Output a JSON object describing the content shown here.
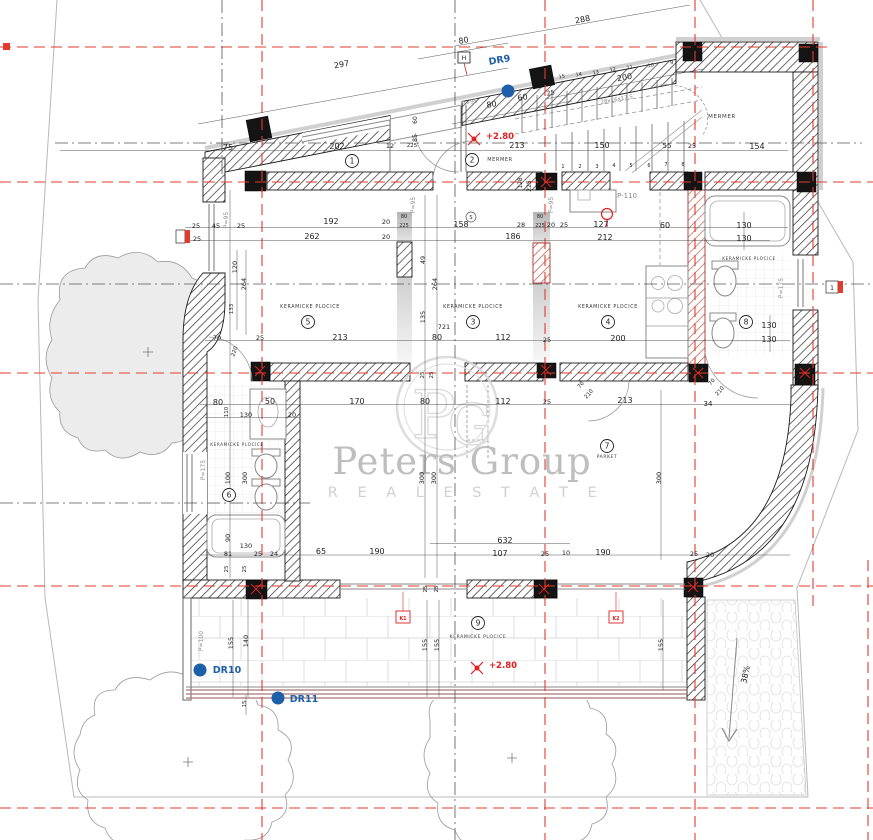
{
  "watermark": {
    "brand": "Peters Group",
    "tagline": "R E A L   E S T A T E"
  },
  "colors": {
    "grid_red": "#e23b2e",
    "axis_gray": "#555",
    "wall_black": "#1a1a1a",
    "accent_blue": "#1d5fa8",
    "elevation_red": "#e02020",
    "watermark_gray": "#b3b3b3",
    "terrace_edge": "#a87878"
  },
  "rooms": [
    {
      "n": "1",
      "x": 352,
      "y": 161
    },
    {
      "n": "2",
      "x": 472,
      "y": 160
    },
    {
      "n": "3",
      "x": 473,
      "y": 322
    },
    {
      "n": "4",
      "x": 608,
      "y": 322
    },
    {
      "n": "5",
      "x": 308,
      "y": 322
    },
    {
      "n": "6",
      "x": 229,
      "y": 495
    },
    {
      "n": "7",
      "x": 607,
      "y": 446
    },
    {
      "n": "8",
      "x": 746,
      "y": 322
    },
    {
      "n": "9",
      "x": 478,
      "y": 623
    }
  ],
  "finishes": [
    {
      "t": "KERAMICKE PLOCICE",
      "x": 310,
      "y": 308,
      "s": 4.8
    },
    {
      "t": "KERAMICKE PLOCICE",
      "x": 473,
      "y": 308,
      "s": 4.8
    },
    {
      "t": "KERAMICKE PLOCICE",
      "x": 608,
      "y": 308,
      "s": 4.8
    },
    {
      "t": "KERAMICKE PLOCICE",
      "x": 237,
      "y": 446,
      "s": 4.2
    },
    {
      "t": "KERAMICKE PLOCICE",
      "x": 749,
      "y": 260,
      "s": 4.2
    },
    {
      "t": "KERAMICKE PLOCICE",
      "x": 478,
      "y": 638,
      "s": 4.5
    },
    {
      "t": "PARKET",
      "x": 607,
      "y": 458,
      "s": 4.5
    },
    {
      "t": "MERMER",
      "x": 500,
      "y": 161,
      "s": 5
    },
    {
      "t": "MERMER",
      "x": 722,
      "y": 118,
      "s": 5.5
    }
  ],
  "labels": [
    {
      "t": "288",
      "x": 583,
      "y": 22,
      "r": -10
    },
    {
      "t": "80",
      "x": 464,
      "y": 43,
      "r": -10
    },
    {
      "t": "297",
      "x": 342,
      "y": 67,
      "r": -10
    },
    {
      "t": "80",
      "x": 492,
      "y": 107,
      "r": -10
    },
    {
      "t": "60",
      "x": 523,
      "y": 100,
      "r": -10
    },
    {
      "t": "25",
      "x": 551,
      "y": 95,
      "r": -10,
      "s": 6.5
    },
    {
      "t": "200",
      "x": 625,
      "y": 80,
      "r": -10
    },
    {
      "t": "28x16x17.5",
      "x": 617,
      "y": 101,
      "r": -10,
      "s": 5.5,
      "c": "g"
    },
    {
      "t": "DR9",
      "x": 500,
      "y": 63,
      "r": -10,
      "s": 9.5,
      "c": "b"
    },
    {
      "t": "P>95",
      "x": 470,
      "y": 104,
      "r": -12,
      "s": 6,
      "c": "g"
    },
    {
      "t": "H",
      "x": 464,
      "y": 60,
      "s": 6
    },
    {
      "t": "+2.80",
      "x": 500,
      "y": 139,
      "s": 8.5,
      "c": "r"
    },
    {
      "t": "75",
      "x": 228,
      "y": 150
    },
    {
      "t": "202",
      "x": 337,
      "y": 149
    },
    {
      "t": "12",
      "x": 390,
      "y": 148,
      "s": 6.5
    },
    {
      "t": "225",
      "x": 412,
      "y": 147,
      "s": 5.5
    },
    {
      "t": "213",
      "x": 517,
      "y": 148
    },
    {
      "t": "150",
      "x": 602,
      "y": 148
    },
    {
      "t": "55",
      "x": 667,
      "y": 148,
      "s": 7
    },
    {
      "t": "25",
      "x": 692,
      "y": 148,
      "s": 6.5
    },
    {
      "t": "154",
      "x": 757,
      "y": 149
    },
    {
      "t": "60",
      "x": 417,
      "y": 120,
      "r": -90,
      "s": 6
    },
    {
      "t": "85",
      "x": 417,
      "y": 138,
      "r": -90,
      "s": 6
    },
    {
      "t": "128",
      "x": 522,
      "y": 183,
      "r": -90,
      "s": 6
    },
    {
      "t": "225",
      "x": 531,
      "y": 186,
      "r": -90,
      "s": 6
    },
    {
      "t": "P=95",
      "x": 415,
      "y": 205,
      "r": -90,
      "s": 6,
      "c": "g"
    },
    {
      "t": "P=95",
      "x": 553,
      "y": 205,
      "r": -90,
      "s": 6,
      "c": "g"
    },
    {
      "t": "P=95",
      "x": 228,
      "y": 220,
      "r": -90,
      "s": 6,
      "c": "g"
    },
    {
      "t": "P-110",
      "x": 627,
      "y": 198,
      "s": 7,
      "c": "g"
    },
    {
      "t": "25",
      "x": 196,
      "y": 228,
      "s": 6.5
    },
    {
      "t": "25",
      "x": 197,
      "y": 241,
      "s": 6.5
    },
    {
      "t": "45",
      "x": 216,
      "y": 228,
      "s": 6.5
    },
    {
      "t": "25",
      "x": 241,
      "y": 228,
      "s": 6.5
    },
    {
      "t": "192",
      "x": 331,
      "y": 224
    },
    {
      "t": "20",
      "x": 386,
      "y": 224,
      "s": 6.5
    },
    {
      "t": "80",
      "x": 404,
      "y": 218,
      "s": 5
    },
    {
      "t": "225",
      "x": 404,
      "y": 227,
      "s": 5
    },
    {
      "t": "158",
      "x": 461,
      "y": 227
    },
    {
      "t": "28",
      "x": 521,
      "y": 227,
      "s": 6.5
    },
    {
      "t": "20",
      "x": 551,
      "y": 227,
      "s": 6.5
    },
    {
      "t": "25",
      "x": 564,
      "y": 227,
      "s": 6.5
    },
    {
      "t": "80",
      "x": 540,
      "y": 218,
      "s": 5
    },
    {
      "t": "225",
      "x": 540,
      "y": 227,
      "s": 5
    },
    {
      "t": "127",
      "x": 601,
      "y": 227
    },
    {
      "t": "60",
      "x": 665,
      "y": 228
    },
    {
      "t": "130",
      "x": 744,
      "y": 228
    },
    {
      "t": "262",
      "x": 312,
      "y": 239
    },
    {
      "t": "20",
      "x": 386,
      "y": 239,
      "s": 6.5
    },
    {
      "t": "186",
      "x": 513,
      "y": 239
    },
    {
      "t": "212",
      "x": 605,
      "y": 240
    },
    {
      "t": "130",
      "x": 744,
      "y": 241
    },
    {
      "t": "120",
      "x": 237,
      "y": 267,
      "r": -90,
      "s": 6.5
    },
    {
      "t": "264",
      "x": 246,
      "y": 284,
      "r": -90,
      "s": 6.5
    },
    {
      "t": "133",
      "x": 233,
      "y": 309,
      "r": -90,
      "s": 5.5
    },
    {
      "t": "49",
      "x": 425,
      "y": 260,
      "r": -90,
      "s": 6.5
    },
    {
      "t": "264",
      "x": 437,
      "y": 284,
      "r": -90,
      "s": 6.5
    },
    {
      "t": "135",
      "x": 425,
      "y": 317,
      "r": -90,
      "s": 6.5
    },
    {
      "t": "721",
      "x": 444,
      "y": 329,
      "s": 6.5
    },
    {
      "t": "70",
      "x": 217,
      "y": 340,
      "s": 6.5
    },
    {
      "t": "25",
      "x": 260,
      "y": 340,
      "s": 6.5
    },
    {
      "t": "213",
      "x": 340,
      "y": 340
    },
    {
      "t": "80",
      "x": 437,
      "y": 340
    },
    {
      "t": "112",
      "x": 503,
      "y": 340
    },
    {
      "t": "25",
      "x": 547,
      "y": 342,
      "s": 6.5
    },
    {
      "t": "200",
      "x": 618,
      "y": 341
    },
    {
      "t": "130",
      "x": 769,
      "y": 328
    },
    {
      "t": "130",
      "x": 769,
      "y": 342
    },
    {
      "t": "220",
      "x": 236,
      "y": 352,
      "r": -70,
      "s": 5.5
    },
    {
      "t": "80",
      "x": 218,
      "y": 405
    },
    {
      "t": "50",
      "x": 270,
      "y": 404
    },
    {
      "t": "170",
      "x": 357,
      "y": 404
    },
    {
      "t": "80",
      "x": 425,
      "y": 404
    },
    {
      "t": "112",
      "x": 503,
      "y": 404
    },
    {
      "t": "25",
      "x": 547,
      "y": 404,
      "s": 6.5
    },
    {
      "t": "213",
      "x": 625,
      "y": 403
    },
    {
      "t": "34",
      "x": 708,
      "y": 406,
      "s": 7
    },
    {
      "t": "110",
      "x": 228,
      "y": 412,
      "r": -90,
      "s": 5.5
    },
    {
      "t": "130",
      "x": 246,
      "y": 417,
      "s": 6.5
    },
    {
      "t": "20",
      "x": 292,
      "y": 417,
      "s": 6.5
    },
    {
      "t": "25",
      "x": 424,
      "y": 375,
      "r": -90,
      "s": 5.5
    },
    {
      "t": "25",
      "x": 433,
      "y": 375,
      "r": -90,
      "s": 5.5
    },
    {
      "t": "300",
      "x": 424,
      "y": 478,
      "r": -90,
      "s": 6.5
    },
    {
      "t": "300",
      "x": 436,
      "y": 478,
      "r": -90,
      "s": 6.5
    },
    {
      "t": "300",
      "x": 661,
      "y": 478,
      "r": -90,
      "s": 6.5
    },
    {
      "t": "100",
      "x": 230,
      "y": 478,
      "r": -90,
      "s": 6.5
    },
    {
      "t": "300",
      "x": 247,
      "y": 478,
      "r": -90,
      "s": 6.5
    },
    {
      "t": "P=175",
      "x": 205,
      "y": 470,
      "r": -90,
      "s": 6,
      "c": "g"
    },
    {
      "t": "P=175",
      "x": 783,
      "y": 288,
      "r": -90,
      "s": 6,
      "c": "g"
    },
    {
      "t": "90",
      "x": 230,
      "y": 538,
      "r": -90,
      "s": 6.5
    },
    {
      "t": "130",
      "x": 246,
      "y": 548,
      "s": 6.5
    },
    {
      "t": "81",
      "x": 228,
      "y": 556,
      "s": 6.5
    },
    {
      "t": "25",
      "x": 258,
      "y": 556,
      "s": 6.5
    },
    {
      "t": "24",
      "x": 274,
      "y": 556,
      "s": 6.5
    },
    {
      "t": "25",
      "x": 228,
      "y": 569,
      "r": -90,
      "s": 5.5
    },
    {
      "t": "25",
      "x": 246,
      "y": 569,
      "r": -90,
      "s": 5.5
    },
    {
      "t": "65",
      "x": 321,
      "y": 554
    },
    {
      "t": "190",
      "x": 377,
      "y": 554
    },
    {
      "t": "632",
      "x": 505,
      "y": 543
    },
    {
      "t": "107",
      "x": 500,
      "y": 556
    },
    {
      "t": "25",
      "x": 545,
      "y": 556,
      "s": 6.5
    },
    {
      "t": "10",
      "x": 566,
      "y": 555,
      "s": 6.5
    },
    {
      "t": "190",
      "x": 603,
      "y": 555
    },
    {
      "t": "25",
      "x": 694,
      "y": 556,
      "s": 6.5
    },
    {
      "t": "20",
      "x": 710,
      "y": 557,
      "s": 6.5
    },
    {
      "t": "70",
      "x": 582,
      "y": 386,
      "r": -50,
      "s": 5.5
    },
    {
      "t": "210",
      "x": 590,
      "y": 395,
      "r": -50,
      "s": 5.5
    },
    {
      "t": "70",
      "x": 713,
      "y": 383,
      "r": -50,
      "s": 5.5
    },
    {
      "t": "210",
      "x": 721,
      "y": 392,
      "r": -50,
      "s": 5.5
    },
    {
      "t": "155",
      "x": 233,
      "y": 643,
      "r": -90,
      "s": 6.5
    },
    {
      "t": "140",
      "x": 248,
      "y": 641,
      "r": -90,
      "s": 6.5
    },
    {
      "t": "155",
      "x": 427,
      "y": 645,
      "r": -90,
      "s": 6.5
    },
    {
      "t": "155",
      "x": 439,
      "y": 645,
      "r": -90,
      "s": 6.5
    },
    {
      "t": "155",
      "x": 663,
      "y": 645,
      "r": -90,
      "s": 6.5
    },
    {
      "t": "15",
      "x": 246,
      "y": 704,
      "r": -90,
      "s": 5.5
    },
    {
      "t": "25",
      "x": 427,
      "y": 589,
      "r": -90,
      "s": 5.5
    },
    {
      "t": "25",
      "x": 438,
      "y": 589,
      "r": -90,
      "s": 5.5
    },
    {
      "t": "P=100",
      "x": 203,
      "y": 641,
      "r": -90,
      "s": 6,
      "c": "g"
    },
    {
      "t": "DR10",
      "x": 227,
      "y": 673,
      "s": 9.5,
      "c": "b"
    },
    {
      "t": "DR11",
      "x": 304,
      "y": 702,
      "s": 9.5,
      "c": "b"
    },
    {
      "t": "+2.80",
      "x": 503,
      "y": 668,
      "s": 8.5,
      "c": "r"
    },
    {
      "t": "K1",
      "x": 403,
      "y": 620,
      "s": 5,
      "c": "r"
    },
    {
      "t": "K2",
      "x": 616,
      "y": 620,
      "s": 5,
      "c": "r"
    },
    {
      "t": "38%",
      "x": 748,
      "y": 675,
      "r": -78,
      "s": 8
    },
    {
      "t": "1",
      "x": 832,
      "y": 290,
      "s": 6
    },
    {
      "t": "S",
      "x": 471,
      "y": 219,
      "s": 5
    },
    {
      "t": "1",
      "x": 563,
      "y": 168,
      "s": 5
    },
    {
      "t": "2",
      "x": 580,
      "y": 168,
      "s": 5
    },
    {
      "t": "3",
      "x": 597,
      "y": 168,
      "s": 5
    },
    {
      "t": "4",
      "x": 614,
      "y": 167,
      "s": 5
    },
    {
      "t": "5",
      "x": 631,
      "y": 167,
      "s": 5
    },
    {
      "t": "6",
      "x": 649,
      "y": 167,
      "s": 5
    },
    {
      "t": "7",
      "x": 666,
      "y": 166,
      "s": 5
    },
    {
      "t": "8",
      "x": 683,
      "y": 166,
      "s": 5
    },
    {
      "t": "15",
      "x": 562,
      "y": 78,
      "r": -10,
      "s": 5
    },
    {
      "t": "14",
      "x": 579,
      "y": 76,
      "r": -10,
      "s": 5
    },
    {
      "t": "13",
      "x": 596,
      "y": 74,
      "r": -10,
      "s": 5
    },
    {
      "t": "12",
      "x": 613,
      "y": 71,
      "r": -10,
      "s": 5
    },
    {
      "t": "11",
      "x": 630,
      "y": 69,
      "r": -10,
      "s": 5
    },
    {
      "t": "10",
      "x": 651,
      "y": 67,
      "r": -10,
      "s": 5
    },
    {
      "t": "9",
      "x": 672,
      "y": 64,
      "r": -10,
      "s": 5
    }
  ]
}
